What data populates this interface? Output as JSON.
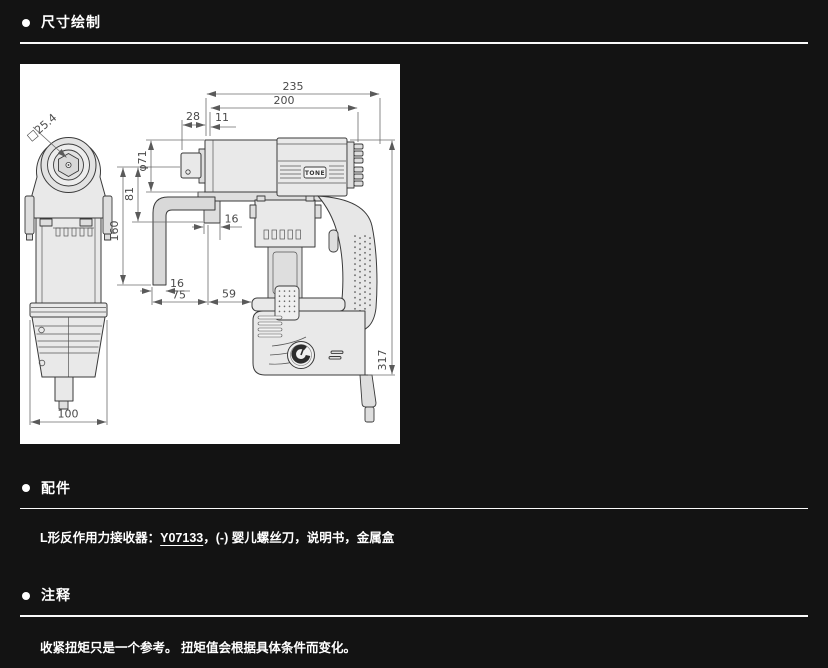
{
  "sections": {
    "drawing": {
      "title": "尺寸绘制"
    },
    "accessories": {
      "title": "配件",
      "label": "L形反作用力接收器：",
      "link": "Y07133",
      "rest": "，(-) 婴儿螺丝刀，说明书，金属盒"
    },
    "notes": {
      "title": "注释",
      "text": "收紧扭矩只是一个参考。 扭矩值会根据具体条件而变化。"
    }
  },
  "drawing": {
    "brand": "TONE",
    "dims": {
      "overall_length": "235",
      "housing_length": "200",
      "drive_length": "28",
      "front_offset": "11",
      "gear_diameter": "φ71",
      "axis_to_plate": "81",
      "arm_drop": "160",
      "plate_width": "16",
      "arm_thickness": "16",
      "arm_reach": "75",
      "plate_to_body": "59",
      "overall_height": "317",
      "front_width": "100",
      "square_drive": "□25.4"
    }
  }
}
